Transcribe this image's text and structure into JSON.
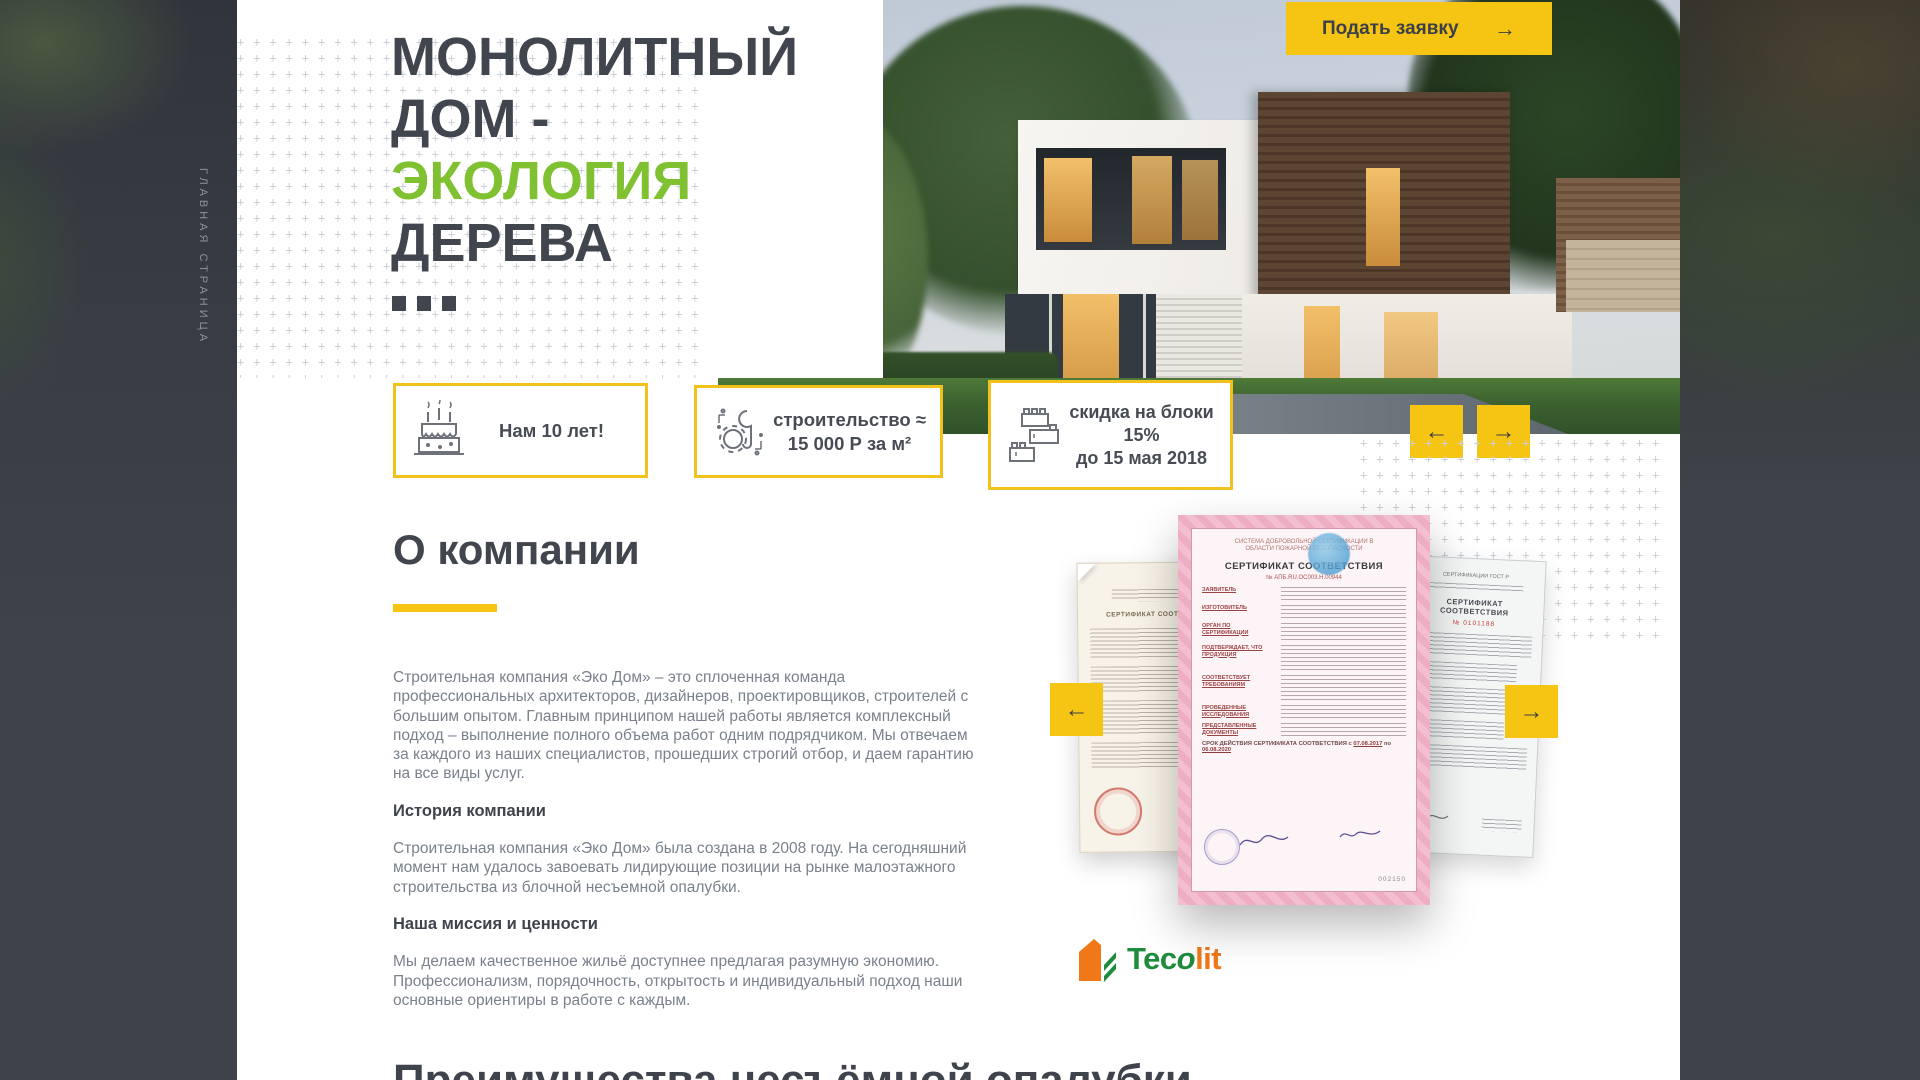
{
  "page": {
    "vertical_label": "ГЛАВНАЯ СТРАНИЦА"
  },
  "colors": {
    "accent_yellow": "#F6C513",
    "brand_green": "#7FC131",
    "heading_dark": "#41454E",
    "body_gray": "#7A818C",
    "logo_green": "#1E8C3C",
    "logo_orange": "#F07818"
  },
  "hero": {
    "title_lines": [
      "МОНОЛИТНЫЙ",
      "ДОМ -",
      "ЭКОЛОГИЯ",
      "ДЕРЕВА"
    ],
    "apply_button": {
      "label": "Подать заявку",
      "arrow": "→"
    },
    "cards": {
      "card1": {
        "icon": "cake-icon",
        "line1": "Нам 10 лет!"
      },
      "card2": {
        "icon": "construction-icon",
        "line1": "строительство ≈",
        "line2": "15 000 Р за м²"
      },
      "card3": {
        "icon": "blocks-icon",
        "line1": "скидка на блоки",
        "line2": "15%",
        "line3": "до 15 мая 2018"
      }
    },
    "carousel": {
      "prev": "←",
      "next": "→"
    }
  },
  "about": {
    "heading": "О компании",
    "paragraph1": "Строительная компания «Эко Дом» – это сплоченная команда профессиональных архитекторов, дизайнеров, проектировщиков, строителей с большим опытом. Главным принципом нашей работы является комплексный подход – выполнение полного объема работ одним подрядчиком. Мы отвечаем за каждого из наших специалистов, прошедших строгий отбор, и даем гарантию на все виды услуг.",
    "subheading1": "История компании",
    "paragraph2": "Строительная компания «Эко Дом» была создана в 2008 году. На сегодняшний момент нам удалось завоевать лидирующие позиции на рынке малоэтажного строительства из блочной несъемной опалубки.",
    "subheading2": "Наша миссия и ценности",
    "paragraph3": "Мы делаем качественное жильё доступнее предлагая разумную экономию. Профессионализм, порядочность, открытость и индивидуальный подход наши основные ориентиры в работе с каждым.",
    "carousel": {
      "prev": "←",
      "next": "→"
    },
    "certificates": {
      "left": {
        "title": "СЕРТИФИКАТ СООТВЕТСТВИЯ"
      },
      "center": {
        "header": "СИСТЕМА ДОБРОВОЛЬНОЙ СЕРТИФИКАЦИИ В ОБЛАСТИ ПОЖАРНОЙ БЕЗОПАСНОСТИ",
        "title": "СЕРТИФИКАТ СООТВЕТСТВИЯ",
        "number_line": "№ АПБ.RU.ОС003.Н.00944",
        "labels": [
          "ЗАЯВИТЕЛЬ",
          "ИЗГОТОВИТЕЛЬ",
          "ОРГАН ПО СЕРТИФИКАЦИИ",
          "ПОДТВЕРЖДАЕТ, ЧТО ПРОДУКЦИЯ",
          "СООТВЕТСТВУЕТ ТРЕБОВАНИЯМ",
          "ПРОВЕДЕННЫЕ ИССЛЕДОВАНИЯ",
          "ПРЕДСТАВЛЕННЫЕ ДОКУМЕНТЫ"
        ],
        "validity_label": "СРОК ДЕЙСТВИЯ СЕРТИФИКАТА СООТВЕТСТВИЯ",
        "validity_from": "07.08.2017",
        "validity_to": "06.08.2020",
        "number": "002150"
      },
      "right": {
        "header": "СЕРТИФИКАЦИИ ГОСТ Р",
        "title": "СЕРТИФИКАТ СООТВЕТСТВИЯ",
        "number": "№ 0101188"
      }
    },
    "logo": {
      "text_green": "Tec",
      "text_o": "o",
      "text_orange": "lit"
    }
  },
  "next_section": {
    "partial_heading": "Преимущества несъёмной опалубки"
  }
}
